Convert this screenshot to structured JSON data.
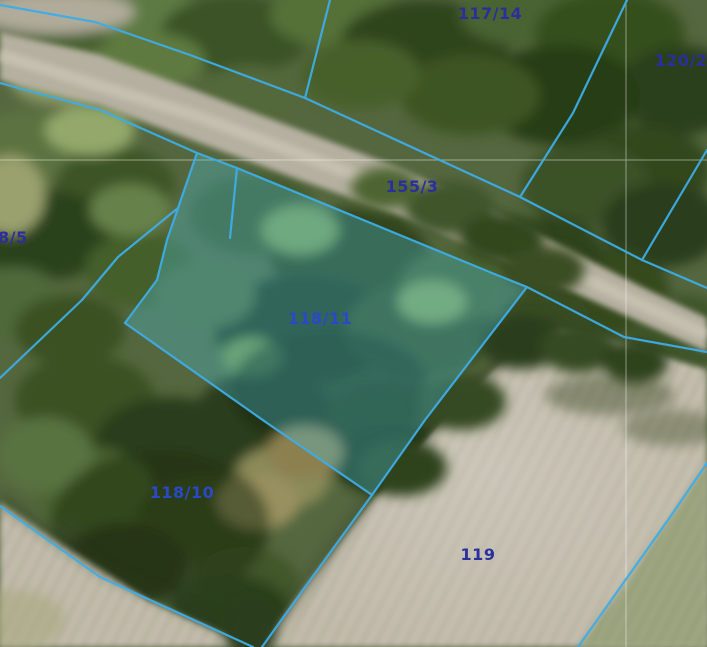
{
  "map": {
    "view": "cadastral-aerial-orthophoto",
    "highlighted_parcel": "118/11",
    "parcel_labels": [
      {
        "text": "117/14"
      },
      {
        "text": "120/2"
      },
      {
        "text": "155/3"
      },
      {
        "text": "8/5"
      },
      {
        "text": "118/11"
      },
      {
        "text": "118/10"
      },
      {
        "text": "119"
      }
    ],
    "colors": {
      "boundary_line": "#3dade8",
      "parcel_label": "#2b2f9d",
      "parcel_label_bright": "#2949c8",
      "highlight_fill": "#4ac4dc",
      "grid_line": "#ffffff"
    }
  }
}
